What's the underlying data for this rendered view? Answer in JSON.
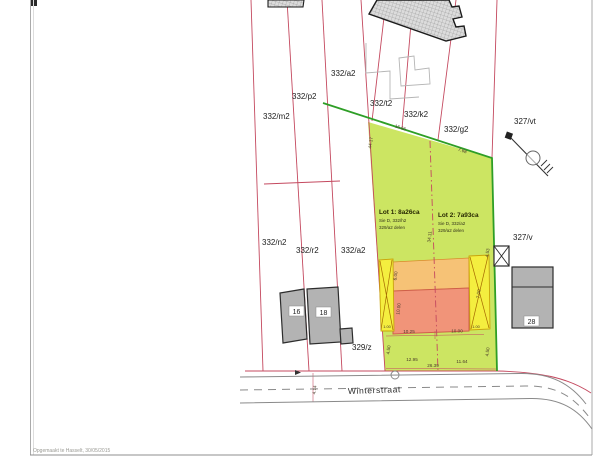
{
  "page": {
    "footer_note": "Opgemaakt te Hasselt, 30/05/2015"
  },
  "street": {
    "name": "Winterstraat"
  },
  "parcels": {
    "m2": "332/m2",
    "p2": "332/p2",
    "a2_top": "332/a2",
    "t2": "332/t2",
    "k2": "332/k2",
    "g2": "332/g2",
    "vt": "327/vt",
    "n2": "332/n2",
    "r2": "332/r2",
    "a2_mid": "332/a2",
    "v": "327/v",
    "z": "329/z"
  },
  "houses": {
    "h16": "16",
    "h18": "18",
    "h28": "28"
  },
  "lots": {
    "lot1": {
      "title": "Lot 1: 8a26ca",
      "ref": "Sie D, 332/h2",
      "note": "329/a2 delen"
    },
    "lot2": {
      "title": "Lot 2: 7a93ca",
      "ref": "Sie D, 332/a2",
      "note": "329/a2 delen"
    }
  },
  "dims": {
    "top_seg1": "16.66",
    "top_seg2": "7.68",
    "left_edge": "44.17",
    "divider": "34.11",
    "right_upper": "4.53",
    "zone_top": "6.00",
    "zone_mid": "10.00",
    "zone_right": "7.00",
    "strip_l": "1.00",
    "strip_r": "1.00",
    "width1": "10.25",
    "width2": "10.00",
    "front1": "12.95",
    "front2": "11.64",
    "front_total": "26.39",
    "setback_l": "4.50",
    "setback_r": "4.50",
    "road_w": "4.14"
  },
  "colors": {
    "parcel_line": "#c4495f",
    "lot_fill": "#c9e45a",
    "lot_edge": "#2e9e26",
    "strip_fill": "#f4ee3f",
    "zone_top_fill": "#f6c276",
    "zone_main_fill": "#f19479",
    "building_fill": "#b3b3b3"
  }
}
